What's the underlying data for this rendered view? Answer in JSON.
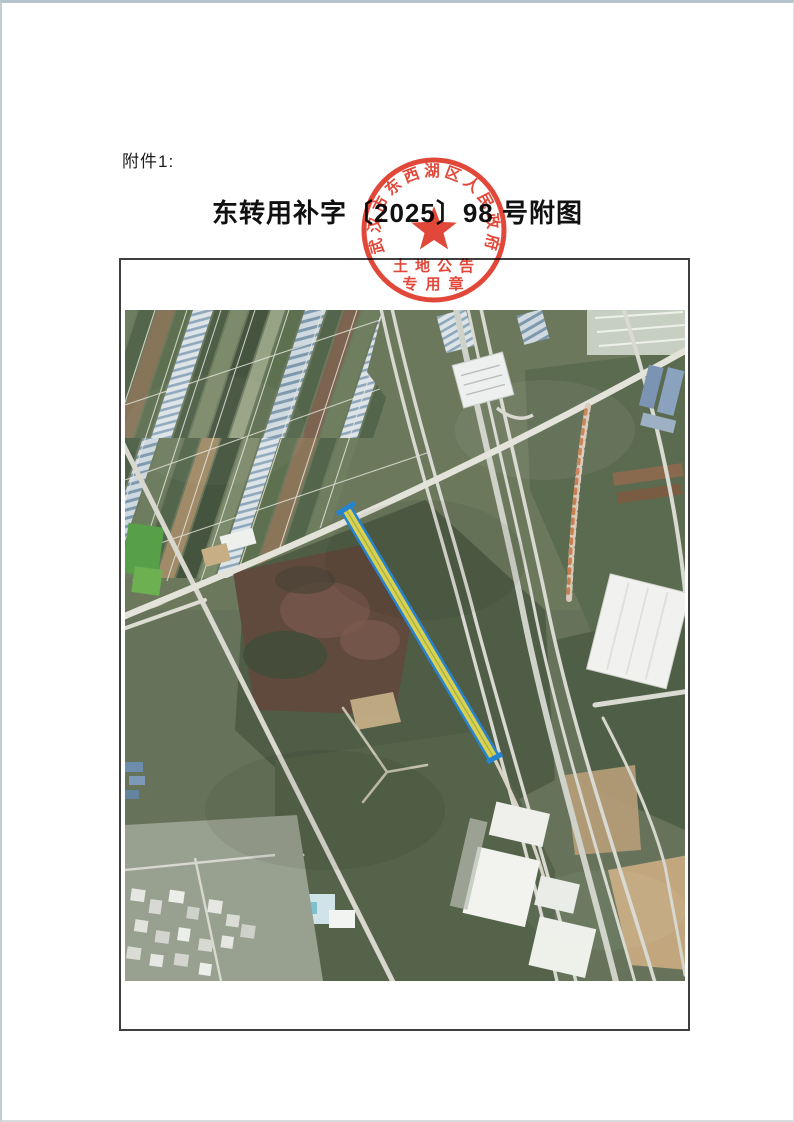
{
  "page": {
    "attachment_label": "附件1:",
    "title": "东转用补字〔2025〕98 号附图"
  },
  "seal": {
    "ring_text": "武汉市东西湖区人民政府",
    "bottom_line1": "土地公告",
    "bottom_line2": "专用章",
    "color": "#e03a2a"
  },
  "map": {
    "type": "satellite-photo",
    "description": "aerial imagery of farmland, greenhouses, roads and warehouses with one highlighted land parcel strip",
    "parcel": {
      "fill": "#d8d153",
      "outline": "#2583d0"
    },
    "colors": {
      "field_green": "#66735a",
      "road": "#e0dfd6"
    }
  }
}
